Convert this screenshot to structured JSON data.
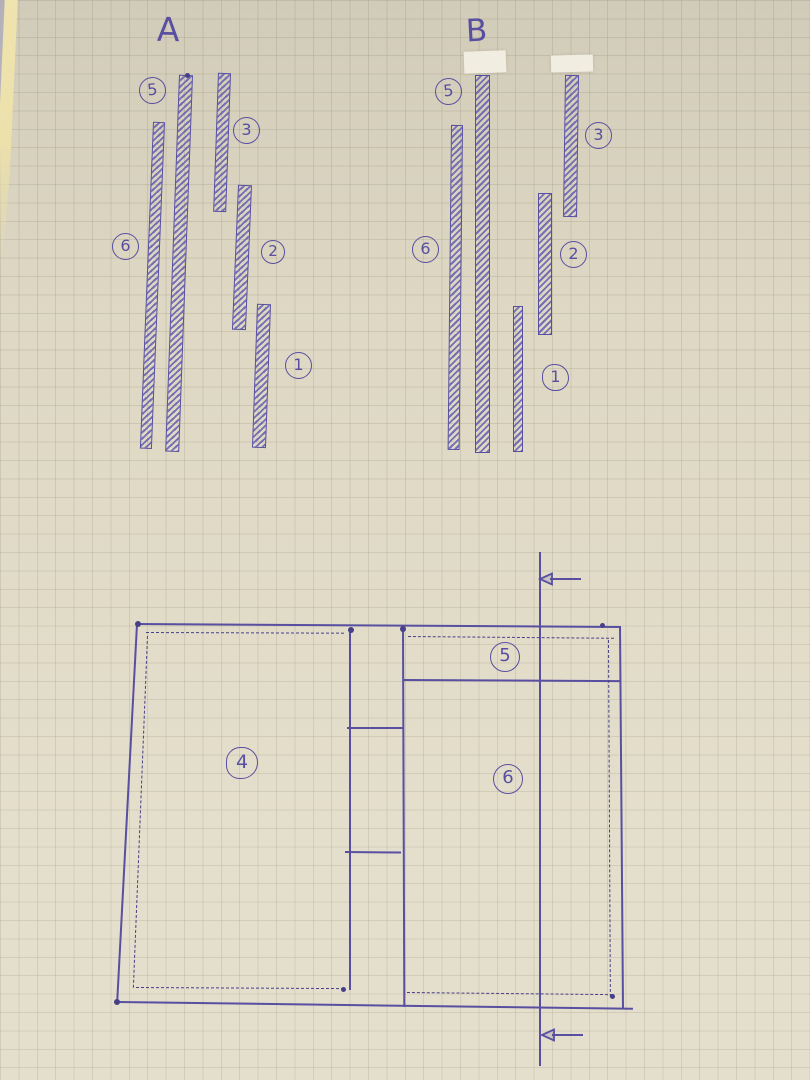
{
  "colors": {
    "ink": "#584fa0",
    "paper": "#e2dcc8",
    "grid_line": "#978c72",
    "tape": "#f2ede1",
    "page_edge_gray": "#b3b0ba",
    "page_edge_yellow": "#eee2ac"
  },
  "diagram_a": {
    "title": "A",
    "pieces": [
      {
        "label": "5"
      },
      {
        "label": "3"
      },
      {
        "label": "6"
      },
      {
        "label": "2"
      },
      {
        "label": "1"
      }
    ]
  },
  "diagram_b": {
    "title": "B",
    "tape_patches": 2,
    "pieces": [
      {
        "label": "5"
      },
      {
        "label": "3"
      },
      {
        "label": "6"
      },
      {
        "label": "2"
      },
      {
        "label": "1"
      }
    ]
  },
  "layout_plan": {
    "labels": [
      {
        "label": "4"
      },
      {
        "label": "5"
      },
      {
        "label": "6"
      }
    ]
  },
  "icons": {
    "measure_arrow": "arrow-left-icon"
  }
}
